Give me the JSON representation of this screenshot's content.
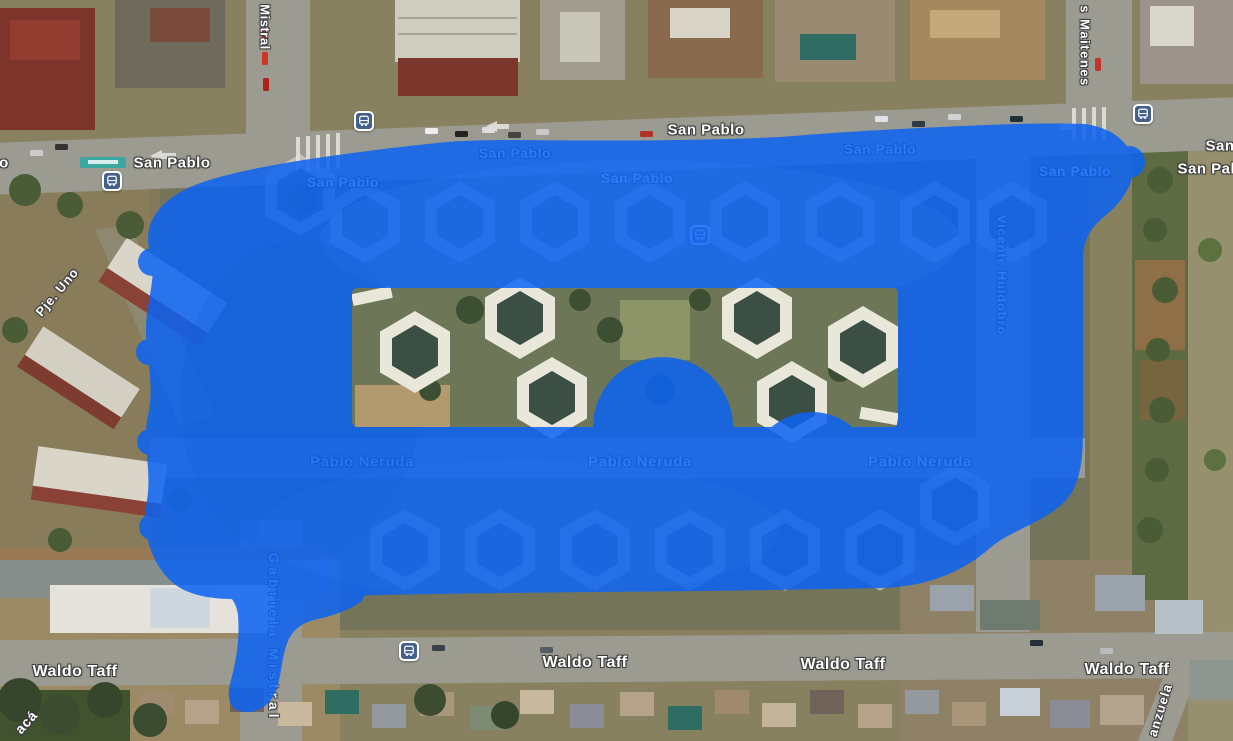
{
  "app": {
    "name": "satellite-map-view"
  },
  "map": {
    "view_type": "satellite",
    "overlay": {
      "label": "painted-highlight-region",
      "color": "#0c63f2",
      "opacity": 0.86
    },
    "street_labels": [
      {
        "text": "Mistral",
        "x": 265,
        "y": 27,
        "rot": 90,
        "size": 13,
        "ls": 0.5
      },
      {
        "text": "s Maitenes",
        "x": 1085,
        "y": 46,
        "rot": 90,
        "size": 13,
        "ls": 1.5
      },
      {
        "text": "o",
        "x": 4,
        "y": 163,
        "rot": 0,
        "size": 15,
        "ls": 0.5
      },
      {
        "text": "San Pablo",
        "x": 172,
        "y": 163,
        "rot": 0,
        "size": 15,
        "ls": 0.5
      },
      {
        "text": "San Pablo",
        "x": 343,
        "y": 182,
        "rot": 0,
        "size": 14,
        "ls": 0.5
      },
      {
        "text": "San Pablo",
        "x": 515,
        "y": 153,
        "rot": 0,
        "size": 14,
        "ls": 0.5
      },
      {
        "text": "San Pablo",
        "x": 637,
        "y": 178,
        "rot": 0,
        "size": 14,
        "ls": 0.5
      },
      {
        "text": "San Pablo",
        "x": 706,
        "y": 130,
        "rot": 0,
        "size": 15,
        "ls": 0.5
      },
      {
        "text": "San Pablo",
        "x": 880,
        "y": 149,
        "rot": 0,
        "size": 14,
        "ls": 0.5
      },
      {
        "text": "San Pablo",
        "x": 1075,
        "y": 171,
        "rot": 0,
        "size": 14,
        "ls": 0.5
      },
      {
        "text": "San",
        "x": 1220,
        "y": 146,
        "rot": 0,
        "size": 15,
        "ls": 0.5
      },
      {
        "text": "San Pablo",
        "x": 1216,
        "y": 169,
        "rot": 0,
        "size": 15,
        "ls": 0.5
      },
      {
        "text": "Pje. Uno",
        "x": 57,
        "y": 292,
        "rot": -50,
        "size": 13,
        "ls": 0.8
      },
      {
        "text": "Vicente Huidobro",
        "x": 1002,
        "y": 275,
        "rot": 90,
        "size": 13,
        "ls": 0.8
      },
      {
        "text": "Pablo Neruda",
        "x": 362,
        "y": 462,
        "rot": 0,
        "size": 15,
        "ls": 0.6
      },
      {
        "text": "Pablo Neruda",
        "x": 640,
        "y": 462,
        "rot": 0,
        "size": 15,
        "ls": 0.6
      },
      {
        "text": "Pablo Neruda",
        "x": 920,
        "y": 462,
        "rot": 0,
        "size": 15,
        "ls": 0.6
      },
      {
        "text": "Gabriela Mistral",
        "x": 274,
        "y": 637,
        "rot": 90,
        "size": 14,
        "ls": 4
      },
      {
        "text": "Waldo Taff",
        "x": 75,
        "y": 672,
        "rot": 0,
        "size": 16,
        "ls": 0.5
      },
      {
        "text": "Waldo Taff",
        "x": 585,
        "y": 663,
        "rot": 0,
        "size": 16,
        "ls": 0.5
      },
      {
        "text": "Waldo Taff",
        "x": 843,
        "y": 665,
        "rot": 0,
        "size": 16,
        "ls": 0.5
      },
      {
        "text": "Waldo Taff",
        "x": 1127,
        "y": 670,
        "rot": 0,
        "size": 16,
        "ls": 0.5
      },
      {
        "text": "anzuela",
        "x": 1160,
        "y": 710,
        "rot": -73,
        "size": 13,
        "ls": 1
      },
      {
        "text": "acá",
        "x": 26,
        "y": 722,
        "rot": -48,
        "size": 14,
        "ls": 0.8
      }
    ],
    "bus_stops": [
      {
        "x": 112,
        "y": 181
      },
      {
        "x": 364,
        "y": 121
      },
      {
        "x": 1143,
        "y": 114
      },
      {
        "x": 409,
        "y": 651
      },
      {
        "x": 700,
        "y": 235
      }
    ]
  }
}
